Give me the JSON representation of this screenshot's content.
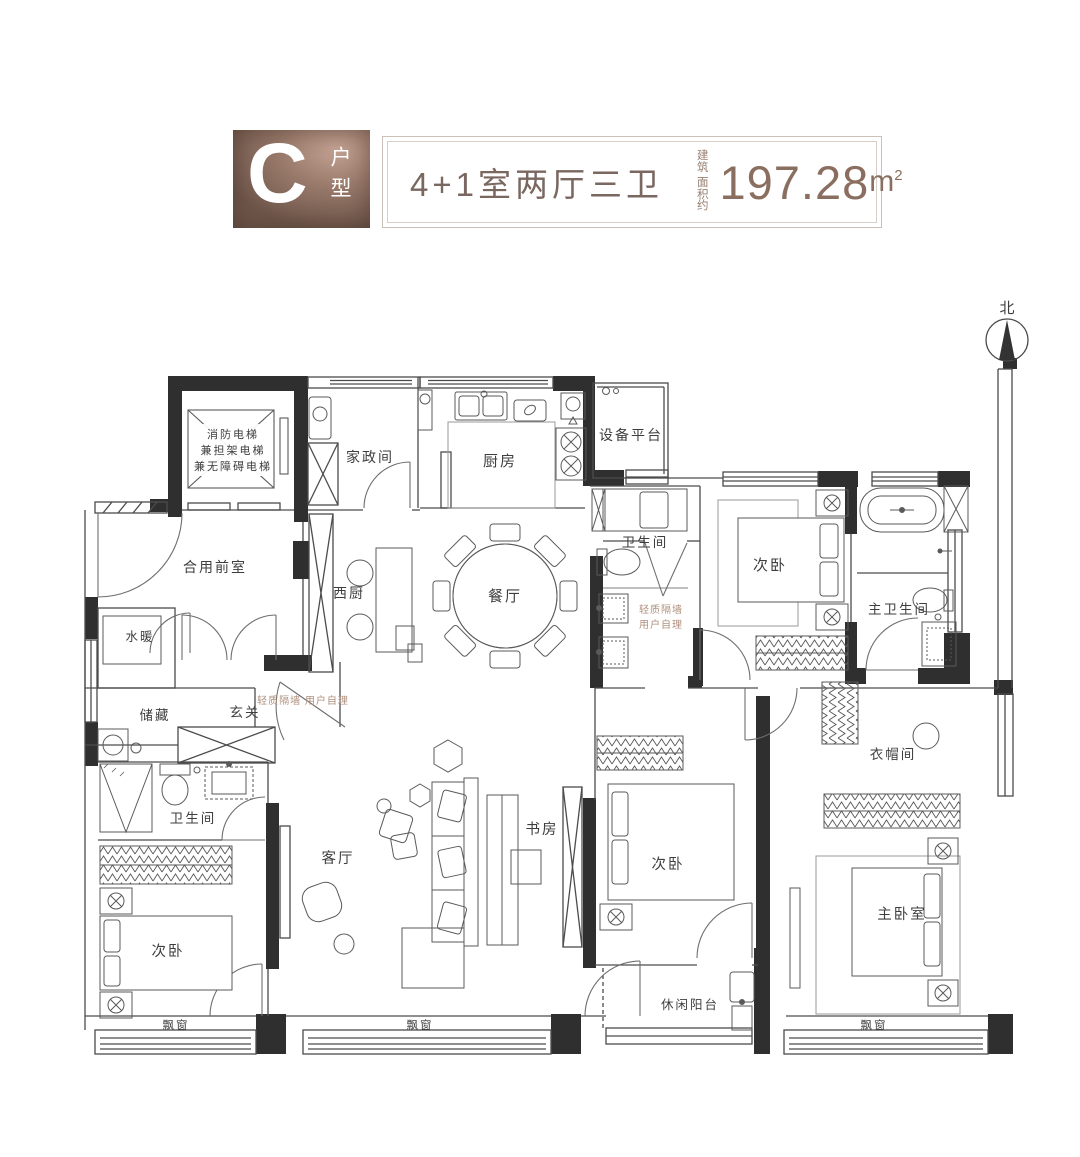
{
  "header": {
    "type_letter": "C",
    "type_label": "户型",
    "layout_title": "4+1室两厅三卫",
    "area_prefix_line1": "建 筑",
    "area_prefix_line2": "面积约",
    "area_value": "197.28",
    "area_unit": "m",
    "area_sup": "2"
  },
  "compass": {
    "north_label": "北"
  },
  "rooms": {
    "elevator_line1": "消防电梯",
    "elevator_line2": "兼担架电梯",
    "elevator_line3": "兼无障碍电梯",
    "housekeeping": "家政间",
    "kitchen": "厨房",
    "equipment_platform": "设备平台",
    "shared_vestibule": "合用前室",
    "west_kitchen": "西厨",
    "dining": "餐厅",
    "bath_middle": "卫生间",
    "bedroom_top_right": "次卧",
    "master_bath": "主卫生间",
    "plumbing": "水暖",
    "storage": "储藏",
    "foyer": "玄关",
    "bath_left": "卫生间",
    "living": "客厅",
    "study": "书房",
    "bedroom_bottom_left": "次卧",
    "bedroom_bottom_middle": "次卧",
    "master_bedroom": "主卧室",
    "cloakroom": "衣帽间",
    "leisure_balcony": "休闲阳台",
    "bay_window_left": "飘窗",
    "bay_window_middle": "飘窗",
    "bay_window_right": "飘窗"
  },
  "annotations": {
    "partition_note_inline": "轻质隔墙 用户自理",
    "partition_note_line1": "轻质隔墙",
    "partition_note_line2": "用户自理"
  },
  "colors": {
    "accent_bronze": "#8d7265",
    "wall": "#2f2f2f",
    "partition_note": "#b08f7d"
  }
}
